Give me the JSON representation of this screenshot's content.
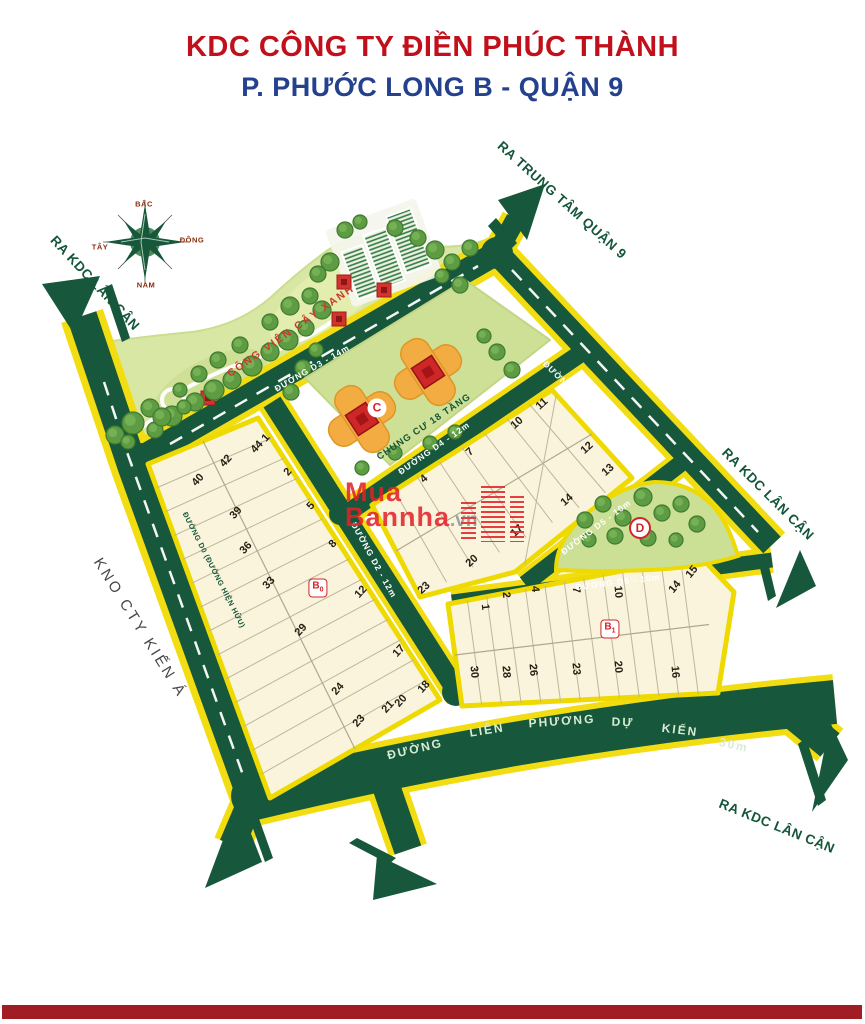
{
  "title": {
    "line1": "KDC CÔNG TY ĐIỀN PHÚC THÀNH",
    "line2": "P. PHƯỚC LONG B - QUẬN 9"
  },
  "compass": {
    "north": "BẮC",
    "south": "NAM",
    "east": "ĐÔNG",
    "west": "TÂY"
  },
  "exits": {
    "top_left": "RA KDC LÂN CẬN",
    "top_right": "RA TRUNG TÂM QUẬN 9",
    "right": "RA KDC LÂN CẬN",
    "bottom_right": "RA KDC LÂN CẬN",
    "neighbor_left": "KNO CTY KIẾN Á"
  },
  "park": {
    "label": "CÔNG VIÊN CÂY XANH"
  },
  "apartment": {
    "badge": "C",
    "label": "CHUNG CƯ 18 TẦNG"
  },
  "roads": {
    "d0": "ĐƯỜNG D0 (ĐƯỜNG HIỆN HỮU)",
    "d1": "ĐƯỜNG D1 - 14m",
    "d2": "ĐƯỜNG D2 - 12m",
    "d3": "ĐƯỜNG D3 - 14m",
    "d4": "ĐƯỜNG D4 - 12m",
    "d5": "ĐƯỜNG D5 - 10m",
    "d6": "ĐƯỜNG D6 - 10m",
    "lien_phuong_words": [
      "ĐƯỜNG",
      "LIÊN",
      "PHƯƠNG",
      "DỰ",
      "KIẾN",
      "30m"
    ]
  },
  "blocks": {
    "b0": {
      "badge_letter": "B",
      "badge_sub": "0",
      "plots": [
        "1",
        "44",
        "42",
        "40",
        "2",
        "39",
        "5",
        "36",
        "8",
        "33",
        "12",
        "29",
        "17",
        "24",
        "18",
        "20",
        "21",
        "23"
      ]
    },
    "central": {
      "plots": [
        "4",
        "7",
        "10",
        "11",
        "12",
        "13",
        "14",
        "17",
        "20",
        "23"
      ]
    },
    "b1": {
      "badge_letter": "B",
      "badge_sub": "1",
      "plots": [
        "1",
        "2",
        "4",
        "7",
        "10",
        "14",
        "15",
        "30",
        "28",
        "26",
        "23",
        "20",
        "16"
      ]
    },
    "d_park": {
      "badge": "D"
    }
  },
  "watermark": {
    "word1": "Mua",
    "word2": "Bannha",
    "suffix": ".vn"
  },
  "colors": {
    "road_green": "#17573B",
    "casing_yellow": "#F2DC12",
    "block_fill": "#FAF4DC",
    "block_border": "#EED900",
    "park_green": "#D9E7A4",
    "title_red": "#C0101B",
    "title_blue": "#24418E",
    "watermark_red": "#E2222A",
    "footer_red": "#A01D23"
  }
}
